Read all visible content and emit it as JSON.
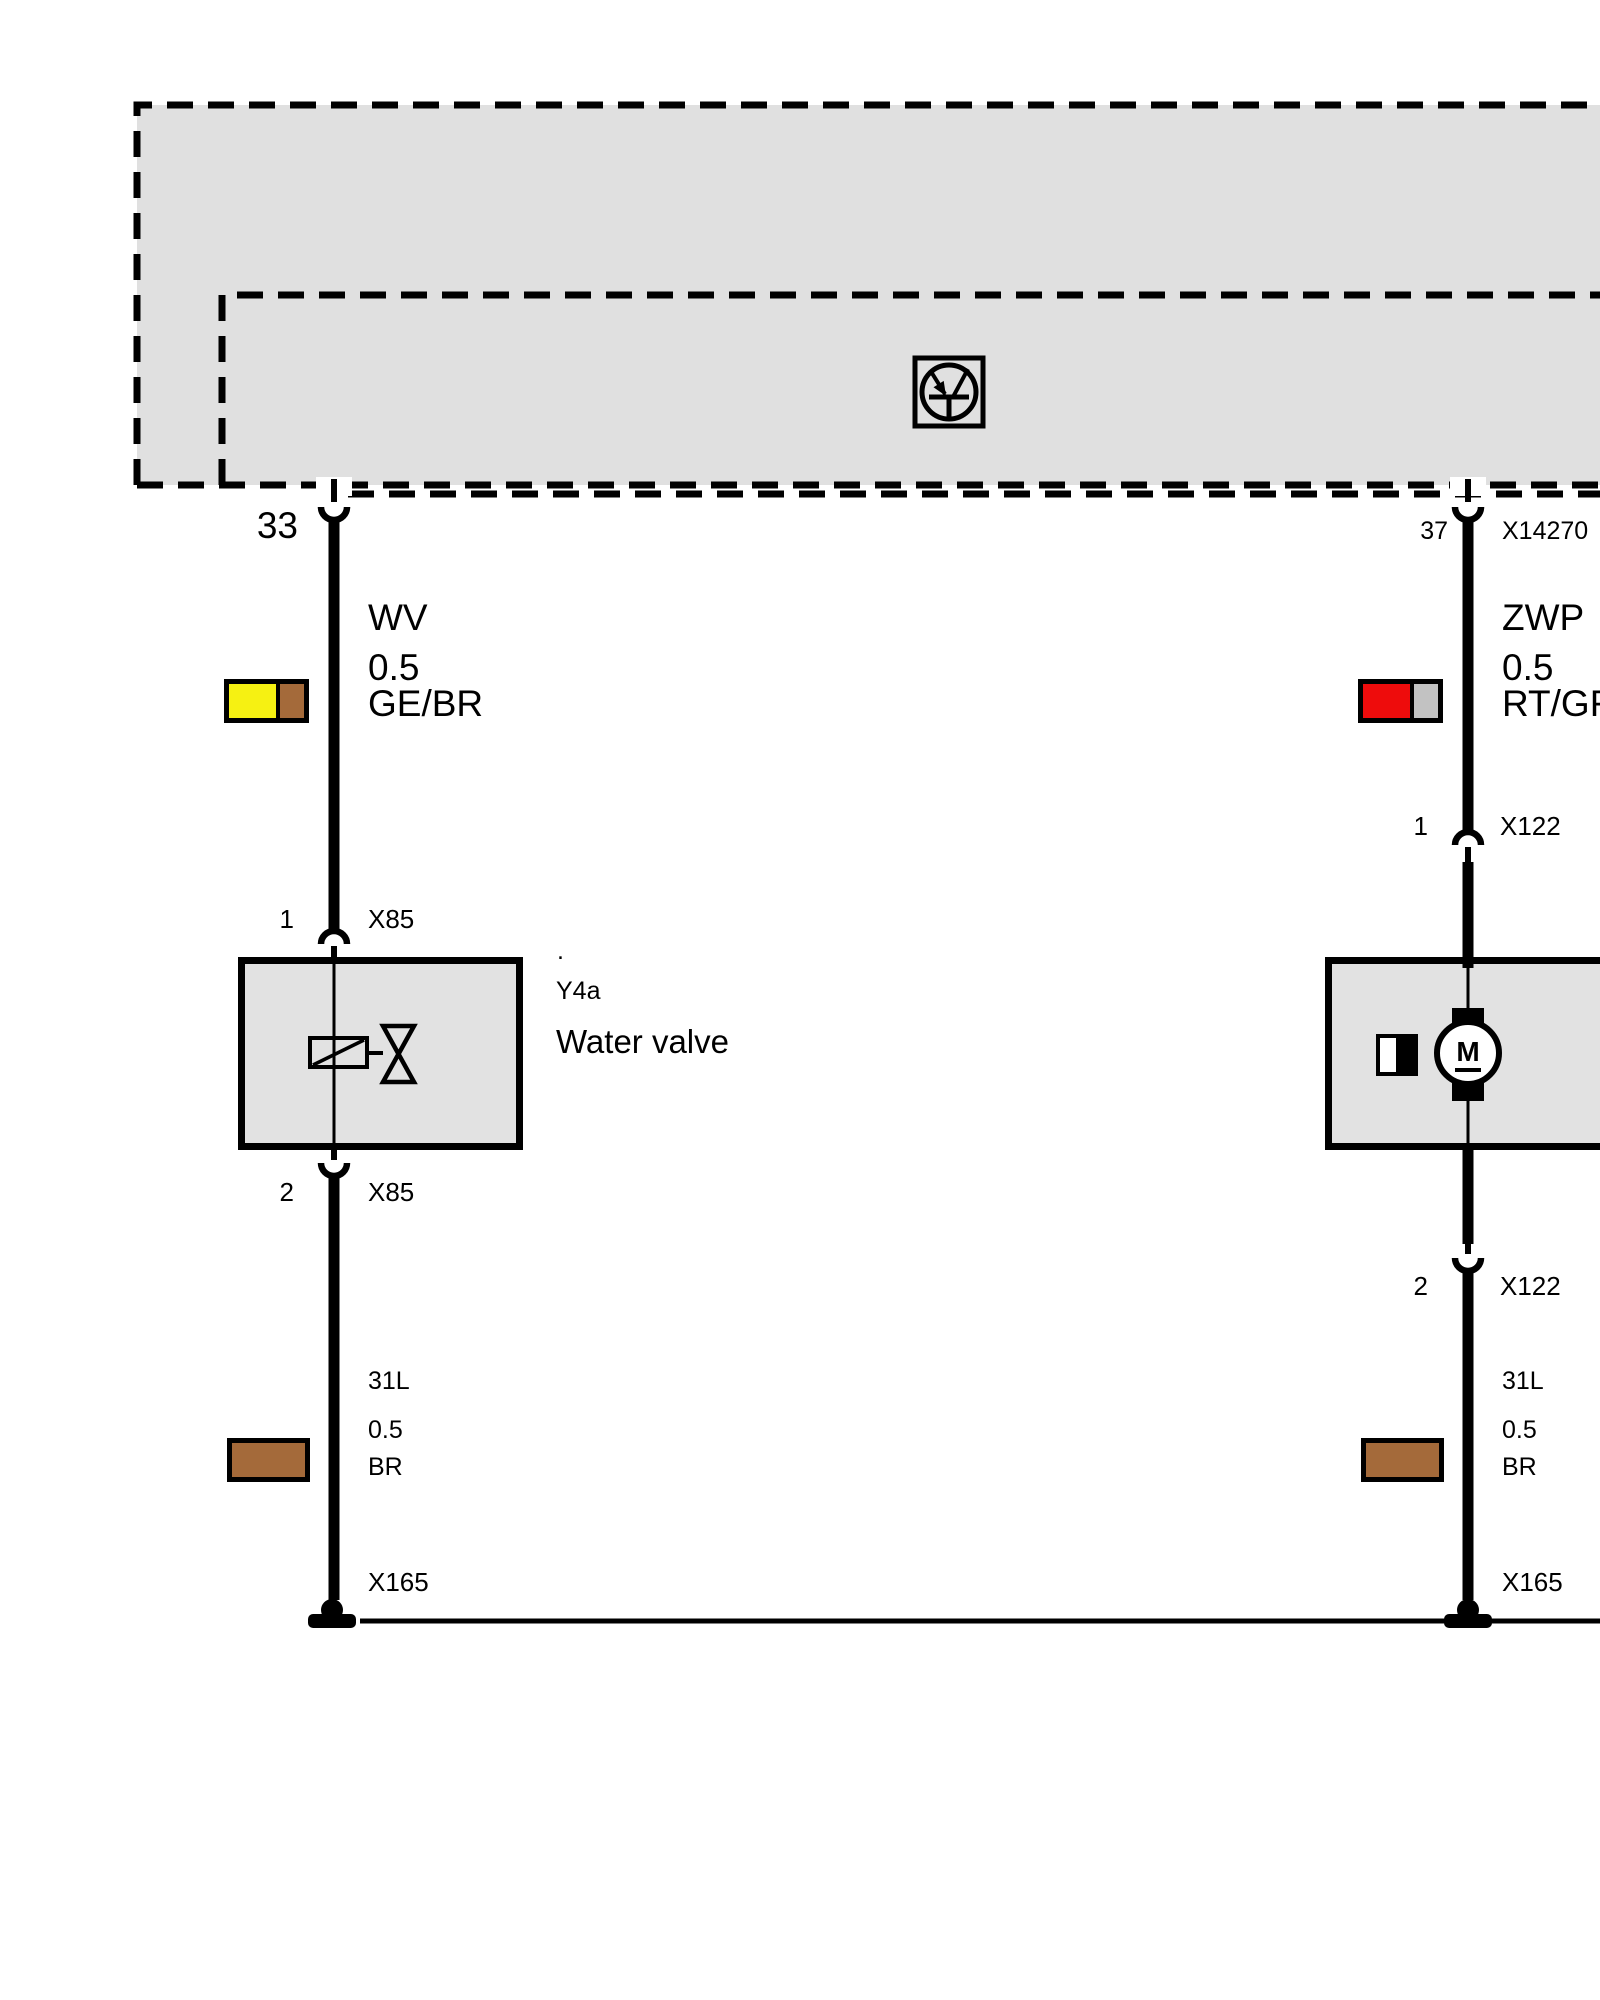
{
  "module": {
    "pin_left": "33",
    "pin_right": "37",
    "connector_right": "X14270",
    "output_icon": "transistor-output-stage"
  },
  "left_branch": {
    "wire_label": "WV",
    "wire_size": "0.5",
    "wire_color_code": "GE/BR",
    "top_pin": "1",
    "top_connector": "X85",
    "component_dot": ".",
    "component_id": "Y4a",
    "component_name": "Water valve",
    "bottom_pin": "2",
    "bottom_connector": "X85",
    "ground_circuit": "31L",
    "ground_size": "0.5",
    "ground_color_code": "BR",
    "ground_connector": "X165"
  },
  "right_branch": {
    "wire_label": "ZWP",
    "wire_size": "0.5",
    "wire_color_code": "RT/GR",
    "top_pin": "1",
    "top_connector": "X122",
    "motor_label": "M",
    "bottom_pin": "2",
    "bottom_connector": "X122",
    "ground_circuit": "31L",
    "ground_size": "0.5",
    "ground_color_code": "BR",
    "ground_connector": "X165"
  },
  "colors": {
    "wire_yellow": "#f6f112",
    "wire_brown": "#a46a3a",
    "wire_red": "#ee0c0c",
    "wire_gray": "#c2c2c2",
    "module_fill": "#e0e0e0",
    "component_fill": "#e2e2e2"
  }
}
